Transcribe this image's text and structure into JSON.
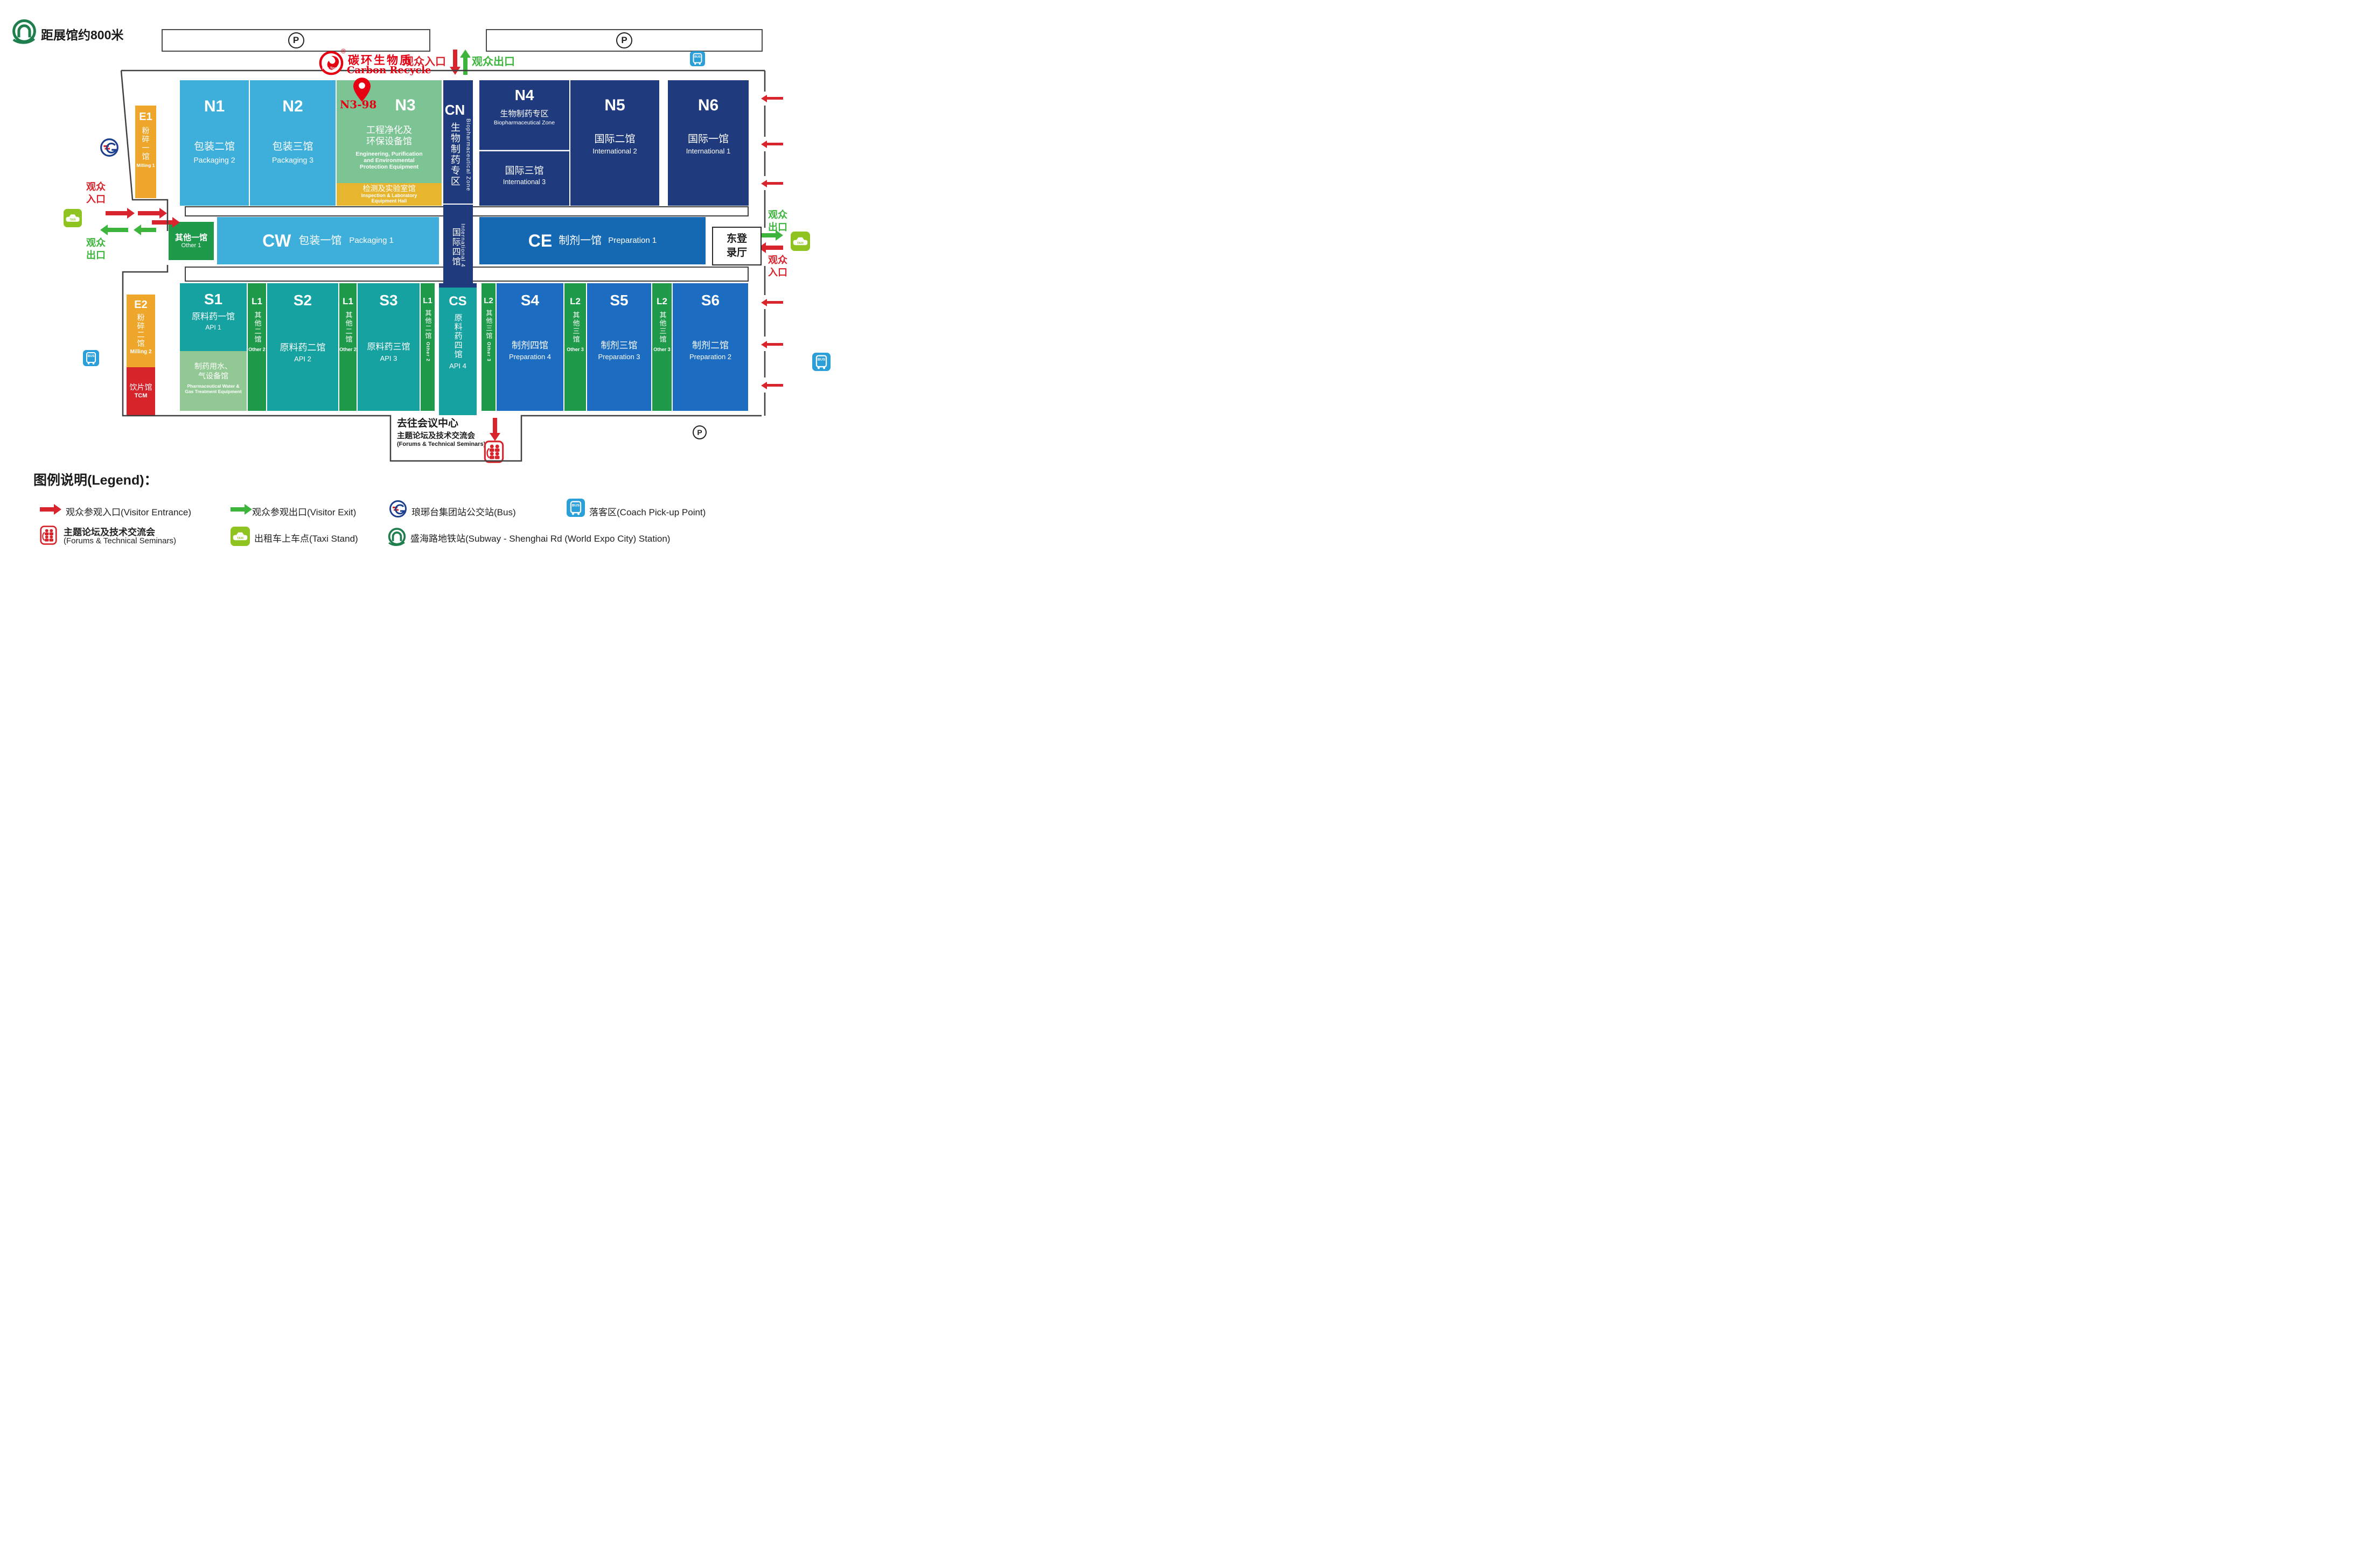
{
  "header": {
    "subway_note": "距展馆约800米",
    "parking_label": "P",
    "entrance_label": "观众入口",
    "exit_label": "观众出口"
  },
  "brand": {
    "cn": "碳环生物质",
    "en": "Carbon Recycle",
    "badge": "Rec Tec",
    "reg": "®"
  },
  "pin_label": "N3-98",
  "halls": {
    "n1": {
      "code": "N1",
      "cn": "包装二馆",
      "en": "Packaging 2"
    },
    "n2": {
      "code": "N2",
      "cn": "包装三馆",
      "en": "Packaging 3"
    },
    "n3": {
      "code": "N3",
      "cn1": "工程净化及",
      "cn2": "环保设备馆",
      "en1": "Engineering, Purification",
      "en2": "and Environmental",
      "en3": "Protection Equipment"
    },
    "lab": {
      "cn": "检测及实验室馆",
      "en1": "Inspection & Laboratory",
      "en2": "Equipment Hall"
    },
    "cn_col": {
      "code": "CN",
      "cn": "生物制药专区",
      "en": "Biopharmaceutical Zone"
    },
    "n4": {
      "code": "N4",
      "top_cn": "生物制药专区",
      "top_en": "Biopharmaceutical Zone",
      "bottom_cn": "国际三馆",
      "bottom_en": "International 3"
    },
    "n5": {
      "code": "N5",
      "cn": "国际二馆",
      "en": "International 2"
    },
    "n6": {
      "code": "N6",
      "cn": "国际一馆",
      "en": "International 1"
    },
    "other1": {
      "cn": "其他一馆",
      "en": "Other 1"
    },
    "cw": {
      "code": "CW",
      "cn": "包装一馆",
      "en": "Packaging 1"
    },
    "intl4": {
      "cn": "国际四馆",
      "en": "International 4"
    },
    "ce": {
      "code": "CE",
      "cn": "制剂一馆",
      "en": "Preparation 1"
    },
    "east_hall": {
      "cn": "东登录厅"
    },
    "s1": {
      "code": "S1",
      "cn": "原料药一馆",
      "en": "API 1"
    },
    "water": {
      "cn1": "制药用水、",
      "cn2": "气设备馆",
      "en1": "Pharmaceutical Water &",
      "en2": "Gas Treatment Equipment"
    },
    "l1": {
      "code": "L1",
      "cn": "其他二馆",
      "en": "Other 2"
    },
    "s2": {
      "code": "S2",
      "cn": "原料药二馆",
      "en": "API 2"
    },
    "s3": {
      "code": "S3",
      "cn": "原料药三馆",
      "en": "API 3"
    },
    "cs": {
      "code": "CS",
      "cn": "原料药四馆",
      "en": "API 4"
    },
    "l2": {
      "code": "L2",
      "cn": "其他三馆",
      "en": "Other 3"
    },
    "s4": {
      "code": "S4",
      "cn": "制剂四馆",
      "en": "Preparation 4"
    },
    "s5": {
      "code": "S5",
      "cn": "制剂三馆",
      "en": "Preparation 3"
    },
    "s6": {
      "code": "S6",
      "cn": "制剂二馆",
      "en": "Preparation 2"
    },
    "e1": {
      "code": "E1",
      "cn": "粉碎一馆",
      "en": "Milling 1"
    },
    "e2": {
      "code": "E2",
      "cn": "粉碎二馆",
      "en": "Milling 2"
    },
    "tcm": {
      "cn": "饮片馆",
      "en": "TCM"
    }
  },
  "annotations": {
    "left_entrance": "观众\n入口",
    "left_exit": "观众\n出口",
    "right_exit": "观众\n出口",
    "right_entrance": "观众\n入口",
    "conference": {
      "line1": "去往会议中心",
      "line2": "主题论坛及技术交流会",
      "line3": "(Forums & Technical Seminars)"
    }
  },
  "icons": {
    "taxi_label": "TAXI",
    "coach_label": "BUS"
  },
  "legend": {
    "title": "图例说明(Legend)：",
    "visitor_entrance": "观众参观入口(Visitor Entrance)",
    "visitor_exit": "观众参观出口(Visitor Exit)",
    "bus": "琅琊台集团站公交站(Bus)",
    "coach": "落客区(Coach Pick-up Point)",
    "forums1": "主题论坛及技术交流会",
    "forums2": "(Forums & Technical Seminars)",
    "taxi": "出租车上车点(Taxi Stand)",
    "subway": "盛海路地铁站(Subway - Shenghai Rd (World Expo City) Station)"
  },
  "colors": {
    "light_blue": "#3eafda",
    "hall_green": "#7cc493",
    "hall_yellow": "#e7b52e",
    "navy": "#1f3a7d",
    "teal": "#17a2a2",
    "dark_green": "#1f9a4b",
    "light_green": "#92c893",
    "mid_blue": "#1c6dc1",
    "ce_blue": "#1569b3",
    "orange": "#eea62b",
    "tcm_red": "#d7242b",
    "accent_red": "#e60012",
    "accent_green": "#3db53c",
    "coach_blue": "#2b9fd8",
    "taxi_green": "#8fc31f"
  }
}
